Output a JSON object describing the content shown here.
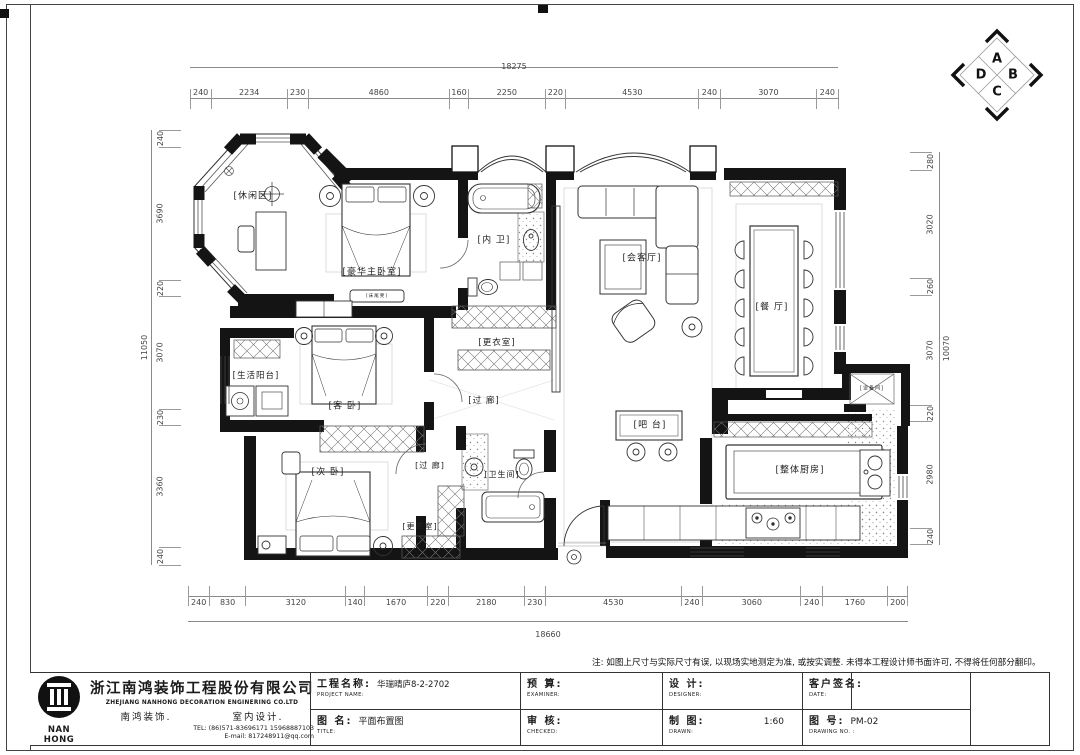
{
  "sheet": {
    "note": "注: 如图上尺寸与实际尺寸有误, 以现场实地测定为准, 或按实调整. 未得本工程设计师书面许可, 不得将任何部分翻印。",
    "orientation": {
      "top": "A",
      "right": "B",
      "bottom": "C",
      "left": "D"
    }
  },
  "rooms": [
    {
      "label": "[休闲区]",
      "x": 253,
      "y": 197,
      "fs": 9
    },
    {
      "label": "[豪华主卧室]",
      "x": 372,
      "y": 273,
      "fs": 9
    },
    {
      "label": "[内 卫]",
      "x": 494,
      "y": 241,
      "fs": 9
    },
    {
      "label": "[更衣室]",
      "x": 497,
      "y": 343,
      "fs": 8.5
    },
    {
      "label": "[会客厅]",
      "x": 642,
      "y": 259,
      "fs": 9
    },
    {
      "label": "[餐 厅]",
      "x": 772,
      "y": 308,
      "fs": 9
    },
    {
      "label": "[生活阳台]",
      "x": 256,
      "y": 376,
      "fs": 8.5
    },
    {
      "label": "[客 卧]",
      "x": 345,
      "y": 407,
      "fs": 9
    },
    {
      "label": "[过 廊]",
      "x": 484,
      "y": 401,
      "fs": 8.5
    },
    {
      "label": "[次 卧]",
      "x": 328,
      "y": 473,
      "fs": 9
    },
    {
      "label": "[过 廊]",
      "x": 430,
      "y": 466,
      "fs": 8
    },
    {
      "label": "[卫生间]",
      "x": 502,
      "y": 475,
      "fs": 8
    },
    {
      "label": "[更衣室]",
      "x": 420,
      "y": 527,
      "fs": 8
    },
    {
      "label": "[吧 台]",
      "x": 650,
      "y": 426,
      "fs": 9
    },
    {
      "label": "[整体厨房]",
      "x": 800,
      "y": 471,
      "fs": 9
    },
    {
      "label": "[设备间]",
      "x": 872,
      "y": 389,
      "fs": 5
    },
    {
      "label": "[床尾凳]",
      "x": 377,
      "y": 297,
      "fs": 4.5
    }
  ],
  "dims": {
    "top": {
      "total": "18275",
      "segments": [
        240,
        2234,
        230,
        4860,
        160,
        2250,
        220,
        4530,
        240,
        3070,
        240
      ]
    },
    "bottom": {
      "total": "18660",
      "segments": [
        240,
        830,
        3120,
        140,
        1670,
        220,
        2180,
        230,
        4530,
        240,
        3060,
        240,
        1760,
        200
      ]
    },
    "left": {
      "total": "11050",
      "segments": [
        240,
        3690,
        220,
        3070,
        230,
        3360,
        240
      ]
    },
    "right": {
      "total": "10070",
      "segments": [
        280,
        3020,
        260,
        3070,
        220,
        2980,
        240
      ]
    }
  },
  "title_block": {
    "logo_text": "NAN HONG",
    "company_cn": "浙江南鸿装饰工程股份有限公司",
    "company_en": "ZHEJIANG NANHONG DECORATION ENGINERING CO.LTD",
    "brand": "南鸿装饰.",
    "dept": "室内设计.",
    "tel": "TEL: (86)571-83696171 15968887103",
    "email": "E-mail: 817248911@qq.com",
    "project_label": "工程名称:",
    "project_value": "华瑞晴庐8-2-2702",
    "project_sub": "PROJECT NAME:",
    "drawing_label": "图 名:",
    "drawing_value": "平面布置图",
    "drawing_sub": "TITLE:",
    "budget_label": "预 算:",
    "budget_sub": "EXAMINER:",
    "check_label": "审 核:",
    "check_sub": "CHECKED:",
    "design_label": "设 计:",
    "design_sub": "DESIGNER:",
    "draft_label": "制 图:",
    "draft_value": "1:60",
    "draft_sub": "DRAWN:",
    "sign_label": "客户签名:",
    "sign_sub": "DATE:",
    "no_label": "图 号:",
    "no_value": "PM-02",
    "no_sub": "DRAWING NO. :"
  }
}
